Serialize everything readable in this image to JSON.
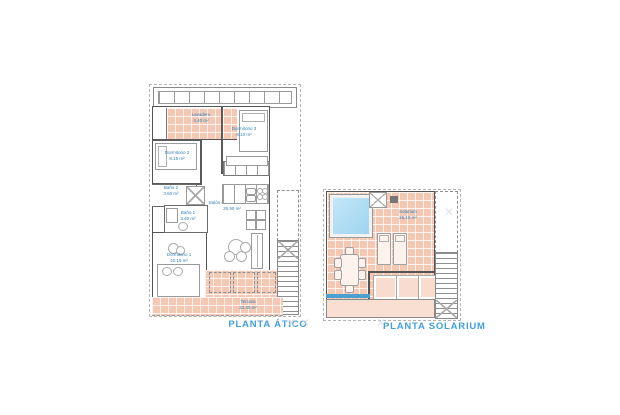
{
  "plan_atico": {
    "title": "PLANTA ÁTICO",
    "rooms": [
      {
        "name": "Lavadero",
        "area": "4.40 m²"
      },
      {
        "name": "Dormitorio 3",
        "area": "8.10 m²"
      },
      {
        "name": "Dormitorio 2",
        "area": "8.15 m²"
      },
      {
        "name": "Baño 2",
        "area": "3.60 m²"
      },
      {
        "name": "Baño 1",
        "area": "3.40 m²"
      },
      {
        "name": "Salón Comedor Cocina",
        "area": "25.90 m²"
      },
      {
        "name": "Dormitorio 1",
        "area": "10.15 m²"
      },
      {
        "name": "Terraza",
        "area": "23.40 m²"
      }
    ]
  },
  "plan_solarium": {
    "title": "PLANTA SOLARIUM",
    "rooms": [
      {
        "name": "Solarium",
        "area": "26.10 m²"
      }
    ]
  },
  "colors": {
    "tile": "#f5c8b4",
    "tile_light": "#f9ded2",
    "wall": "#5a5a5a",
    "label_blue": "#2e7fb7",
    "title_blue": "#3fa0da",
    "pool_blue": "#9ed4f0",
    "railing_blue": "#4d9fd0"
  },
  "decor": {
    "cross_glyph": "✕"
  }
}
